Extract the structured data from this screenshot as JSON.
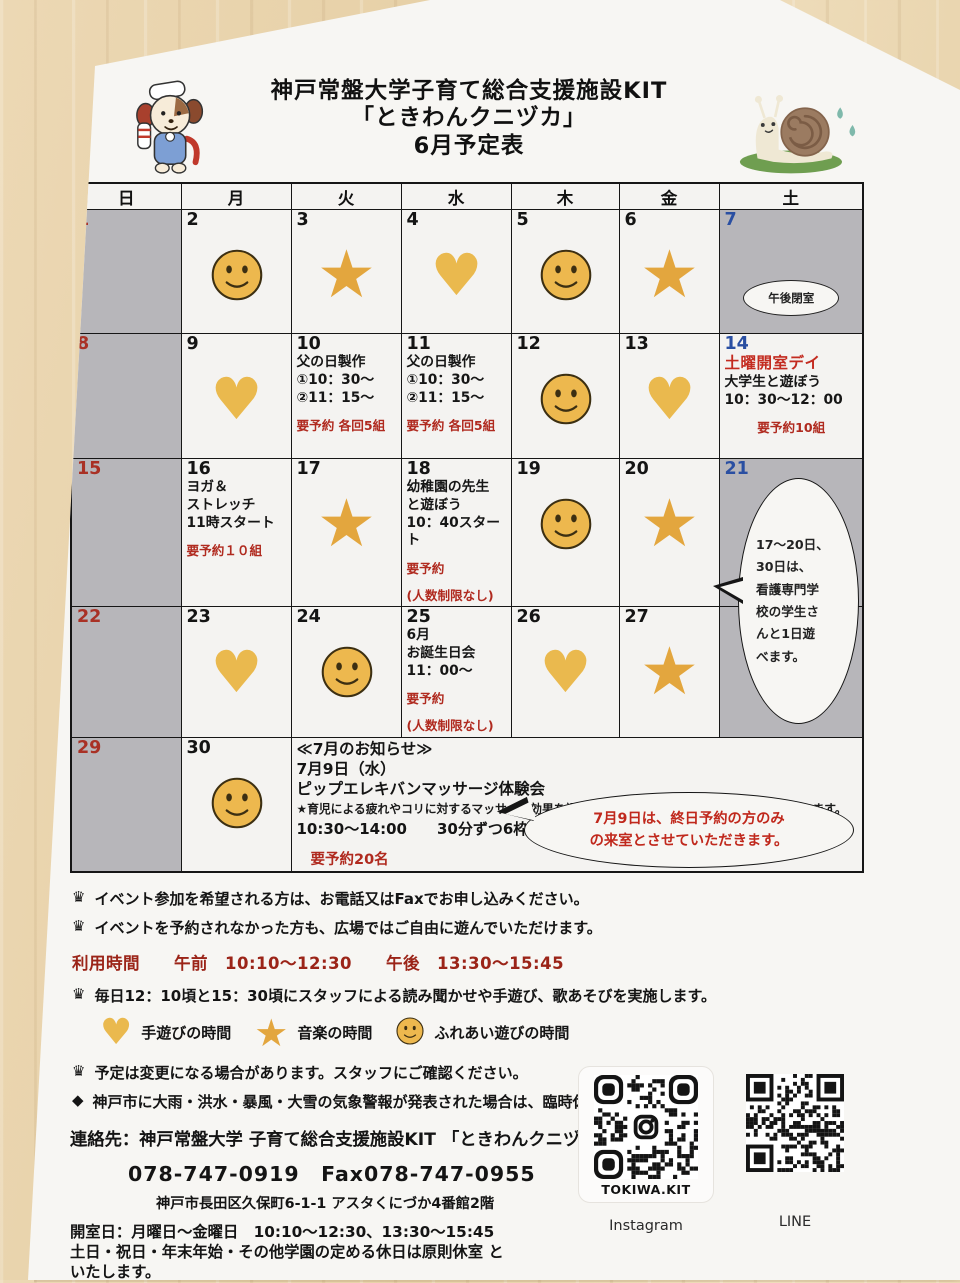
{
  "colors": {
    "wood_background": "#e9d4ae",
    "paper": "#f7f6f3",
    "closed_cell_gray": "#b7b6ba",
    "sunday_red": "#a93125",
    "saturday_blue": "#2a4fa2",
    "event_red": "#b02a1f",
    "icon_yellow": "#eab94e",
    "star_orange": "#e3a63e"
  },
  "header": {
    "title": "神戸常盤大学子育て総合支援施設KIT",
    "subtitle": "「ときわんクニヅカ」",
    "month_title": "6月予定表"
  },
  "weekdays": [
    "日",
    "月",
    "火",
    "水",
    "木",
    "金",
    "土"
  ],
  "calendar": {
    "weeks": [
      {
        "days": [
          {
            "n": "1",
            "off": true,
            "nc": "r"
          },
          {
            "n": "2",
            "icon": "smile"
          },
          {
            "n": "3",
            "icon": "star"
          },
          {
            "n": "4",
            "icon": "heart"
          },
          {
            "n": "5",
            "icon": "smile"
          },
          {
            "n": "6",
            "icon": "star"
          },
          {
            "n": "7",
            "off": true,
            "nc": "b",
            "bubble": "午後閉室"
          }
        ]
      },
      {
        "days": [
          {
            "n": "8",
            "off": true,
            "nc": "r"
          },
          {
            "n": "9",
            "icon": "heart"
          },
          {
            "n": "10",
            "lines": [
              {
                "t": "父の日製作"
              },
              {
                "t": "①10：30～"
              },
              {
                "t": "②11：15～"
              },
              {
                "t": "要予約 各回5組",
                "c": "r",
                "gap": true
              }
            ]
          },
          {
            "n": "11",
            "lines": [
              {
                "t": "父の日製作"
              },
              {
                "t": "①10：30～"
              },
              {
                "t": "②11：15～"
              },
              {
                "t": "要予約 各回5組",
                "c": "r",
                "gap": true
              }
            ]
          },
          {
            "n": "12",
            "icon": "smile"
          },
          {
            "n": "13",
            "icon": "heart"
          },
          {
            "n": "14",
            "nc": "b",
            "lines": [
              {
                "t": "土曜開室デイ",
                "c": "r",
                "big": true
              },
              {
                "t": "大学生と遊ぼう"
              },
              {
                "t": "10：30～12：00"
              },
              {
                "t": "要予約10組",
                "c": "r",
                "gap": true,
                "center": true
              }
            ]
          }
        ]
      },
      {
        "days": [
          {
            "n": "15",
            "off": true,
            "nc": "r"
          },
          {
            "n": "16",
            "lines": [
              {
                "t": "ヨガ＆"
              },
              {
                "t": "ストレッチ"
              },
              {
                "t": "11時スタート"
              },
              {
                "t": "要予約１０組",
                "c": "r",
                "gap": true
              }
            ]
          },
          {
            "n": "17",
            "icon": "star"
          },
          {
            "n": "18",
            "lines": [
              {
                "t": "幼稚園の先生"
              },
              {
                "t": "と遊ぼう"
              },
              {
                "t": "10：40スター"
              },
              {
                "t": "ト"
              },
              {
                "t": "要予約",
                "c": "r",
                "gap": true
              },
              {
                "t": "(人数制限なし)",
                "c": "r",
                "gap": true
              }
            ]
          },
          {
            "n": "19",
            "icon": "smile"
          },
          {
            "n": "20",
            "icon": "star"
          },
          {
            "n": "21",
            "off": true,
            "nc": "b"
          }
        ]
      },
      {
        "days": [
          {
            "n": "22",
            "off": true,
            "nc": "r"
          },
          {
            "n": "23",
            "icon": "heart"
          },
          {
            "n": "24",
            "icon": "smile"
          },
          {
            "n": "25",
            "lines": [
              {
                "t": "6月"
              },
              {
                "t": "お誕生日会"
              },
              {
                "t": "11：00～"
              },
              {
                "t": "要予約",
                "c": "r",
                "gap": true
              },
              {
                "t": "(人数制限なし)",
                "c": "r",
                "gap": true
              }
            ]
          },
          {
            "n": "26",
            "icon": "heart"
          },
          {
            "n": "27",
            "icon": "star"
          },
          {
            "n": "",
            "off": true
          }
        ]
      },
      {
        "days": [
          {
            "n": "29",
            "off": true,
            "nc": "r"
          },
          {
            "n": "30",
            "icon": "smile"
          },
          {
            "notice": true
          }
        ]
      }
    ],
    "sat_bubble_lines": [
      "17～20日、",
      "30日は、",
      "看護専門学",
      "校の学生さ",
      "んと1日遊",
      "べます。"
    ],
    "notice": {
      "heading": "≪7月のお知らせ≫",
      "date_line": "7月9日（水）",
      "event_line": "ピップエレキバンマッサージ体験会",
      "star_note": "★育児による疲れやコリに対するマッサージ効果を調査する研究にご協力いただける方を募っています。",
      "time_line": "10:30～14:00　　30分ずつ6枠",
      "reserve_line": "要予約20名",
      "bubble_lines": [
        "7月9日は、終日予約の方のみ",
        "の来室とさせていただきます。"
      ]
    }
  },
  "notes": [
    {
      "icon": "crown",
      "text": "イベント参加を希望される方は、お電話又はFaxでお申し込みください。"
    },
    {
      "icon": "crown",
      "text": "イベントを予約されなかった方も、広場ではご自由に遊んでいただけます。"
    },
    {
      "icon": "",
      "style": "red",
      "text": "利用時間　　午前　10:10～12:30　　午後　13:30～15:45"
    },
    {
      "icon": "crown",
      "text": "毎日12：10頃と15：30頃にスタッフによる読み聞かせや手遊び、歌あそびを実施します。"
    },
    {
      "legend": true
    },
    {
      "icon": "crown",
      "text": "予定は変更になる場合があります。スタッフにご確認ください。"
    },
    {
      "icon": "diamond",
      "text": "神戸市に大雨・洪水・暴風・大雪の気象警報が発表された場合は、臨時休室します。"
    }
  ],
  "legend": [
    {
      "icon": "heart",
      "label": "手遊びの時間"
    },
    {
      "icon": "star",
      "label": "音楽の時間"
    },
    {
      "icon": "smile",
      "label": "ふれあい遊びの時間"
    }
  ],
  "contact": {
    "org_line": "連絡先：神戸常盤大学 子育て総合支援施設KIT 「ときわんクニヅカ」",
    "phone_line": "078-747-0919　Fax078-747-0955",
    "address_line": "神戸市長田区久保町6-1-1 アスタくにづか4番館2階",
    "open_line1": "開室日：月曜日～金曜日　10:10～12:30、13:30～15:45",
    "open_line2": "土日・祝日・年末年始・その他学園の定める休日は原則休室 と",
    "open_line3": "いたします。"
  },
  "qr": {
    "instagram_label": "TOKIWA.KIT",
    "instagram_caption": "Instagram",
    "line_caption": "LINE"
  }
}
